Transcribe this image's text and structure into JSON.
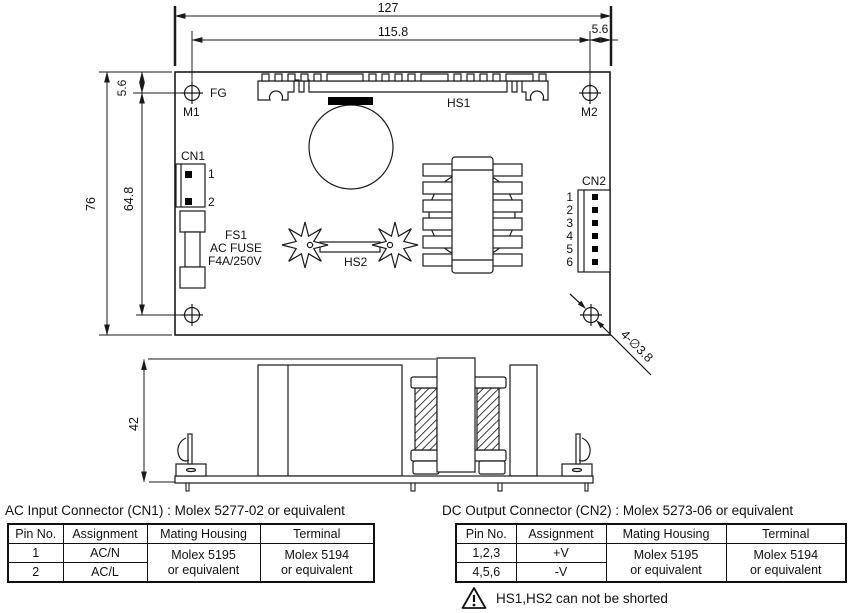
{
  "top_view": {
    "dimensions": {
      "overall_width": "127",
      "hole_span_width": "115.8",
      "right_hole_offset": "5.6",
      "top_hole_offset": "5.6",
      "overall_height": "76",
      "hole_span_height": "64.8"
    },
    "labels": {
      "fg": "FG",
      "m1": "M1",
      "m2": "M2",
      "hs1": "HS1",
      "hs2": "HS2",
      "cn1": "CN1",
      "cn2": "CN2",
      "fs1": "FS1",
      "fuse_type": "AC FUSE",
      "fuse_rating": "F4A/250V",
      "mounting_hole_callout": "4-∅3.8"
    },
    "cn1_pins": [
      "1",
      "2"
    ],
    "cn2_pins": [
      "1",
      "2",
      "3",
      "4",
      "5",
      "6"
    ]
  },
  "side_view": {
    "dimensions": {
      "overall_height": "42"
    }
  },
  "ac_table": {
    "title": "AC Input Connector (CN1) : Molex 5277-02  or equivalent",
    "headers": [
      "Pin No.",
      "Assignment",
      "Mating Housing",
      "Terminal"
    ],
    "rows": [
      [
        "1",
        "AC/N"
      ],
      [
        "2",
        "AC/L"
      ]
    ],
    "mating_housing": [
      "Molex 5195",
      "or equivalent"
    ],
    "terminal": [
      "Molex 5194",
      "or equivalent"
    ]
  },
  "dc_table": {
    "title": "DC Output Connector (CN2) : Molex 5273-06 or equivalent",
    "headers": [
      "Pin No.",
      "Assignment",
      "Mating Housing",
      "Terminal"
    ],
    "rows": [
      [
        "1,2,3",
        "+V"
      ],
      [
        "4,5,6",
        "-V"
      ]
    ],
    "mating_housing": [
      "Molex 5195",
      "or equivalent"
    ],
    "terminal": [
      "Molex 5194",
      "or equivalent"
    ]
  },
  "warning": {
    "text": "HS1,HS2 can not be shorted",
    "icon": "warning-triangle"
  },
  "colors": {
    "line": "#1a1a1a",
    "background": "#ffffff",
    "component_fill": "#000000"
  }
}
